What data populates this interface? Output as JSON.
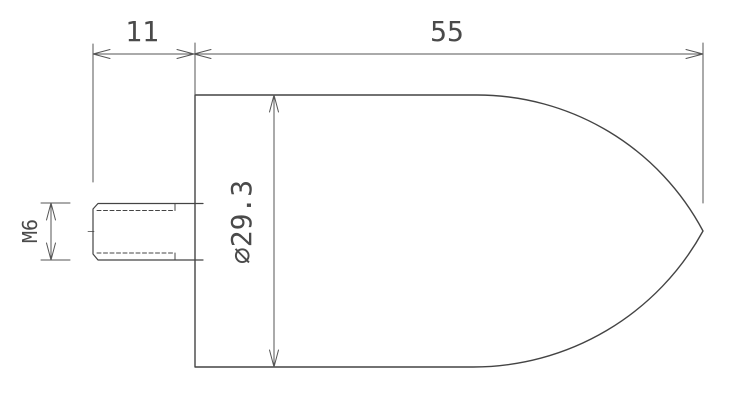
{
  "drawing": {
    "background_color": "#ffffff",
    "outline_color": "#444444",
    "dimension_line_color": "#555555",
    "text_color": "#4a4a4a",
    "labels": {
      "stud_length": "11",
      "body_length": "55",
      "body_diameter": "⌀29.3",
      "thread_size": "M6"
    }
  }
}
